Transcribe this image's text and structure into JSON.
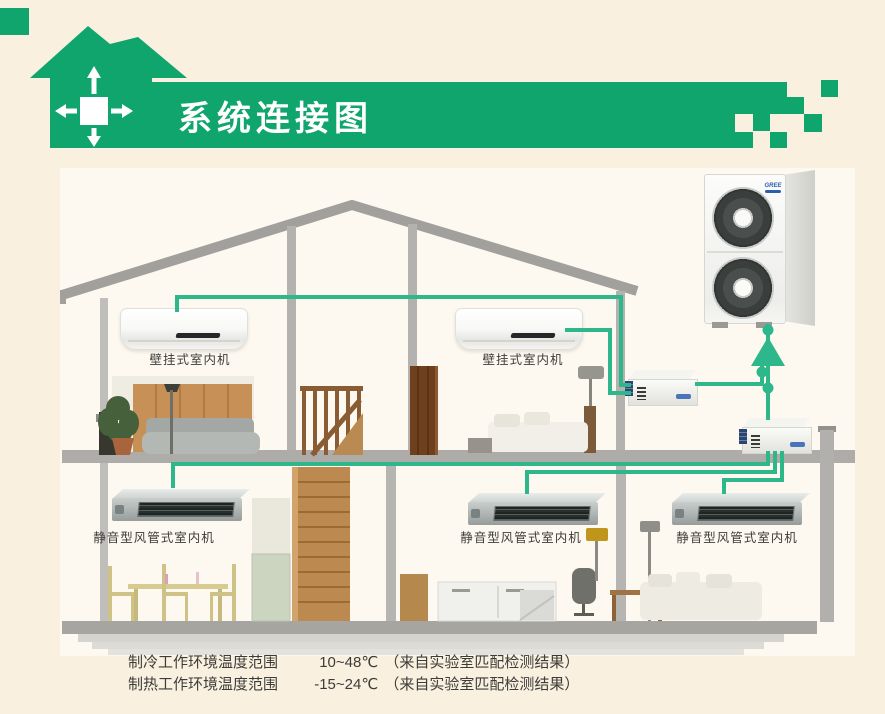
{
  "header": {
    "title": "系统连接图"
  },
  "colors": {
    "background": "#faf0e0",
    "scene_background": "#fdf9f1",
    "brand_green": "#0fa56d",
    "line_green": "#2eb78a",
    "structure_gray": "#a8a6a3",
    "label_text": "#3c3c38"
  },
  "diagram": {
    "outdoor_unit": {
      "brand_logo": "GREE"
    },
    "indoor_units": [
      {
        "id": "wall-unit-1",
        "type": "wall-mounted",
        "label": "壁挂式室内机"
      },
      {
        "id": "wall-unit-2",
        "type": "wall-mounted",
        "label": "壁挂式室内机"
      },
      {
        "id": "duct-unit-1",
        "type": "duct",
        "label": "静音型风管式室内机"
      },
      {
        "id": "duct-unit-2",
        "type": "duct",
        "label": "静音型风管式室内机"
      },
      {
        "id": "duct-unit-3",
        "type": "duct",
        "label": "静音型风管式室内机"
      }
    ]
  },
  "footnotes": [
    {
      "label": "制冷工作环境温度范围",
      "value": "10~48℃",
      "note": "（来自实验室匹配检测结果）"
    },
    {
      "label": "制热工作环境温度范围",
      "value": "-15~24℃",
      "note": "（来自实验室匹配检测结果）"
    }
  ]
}
